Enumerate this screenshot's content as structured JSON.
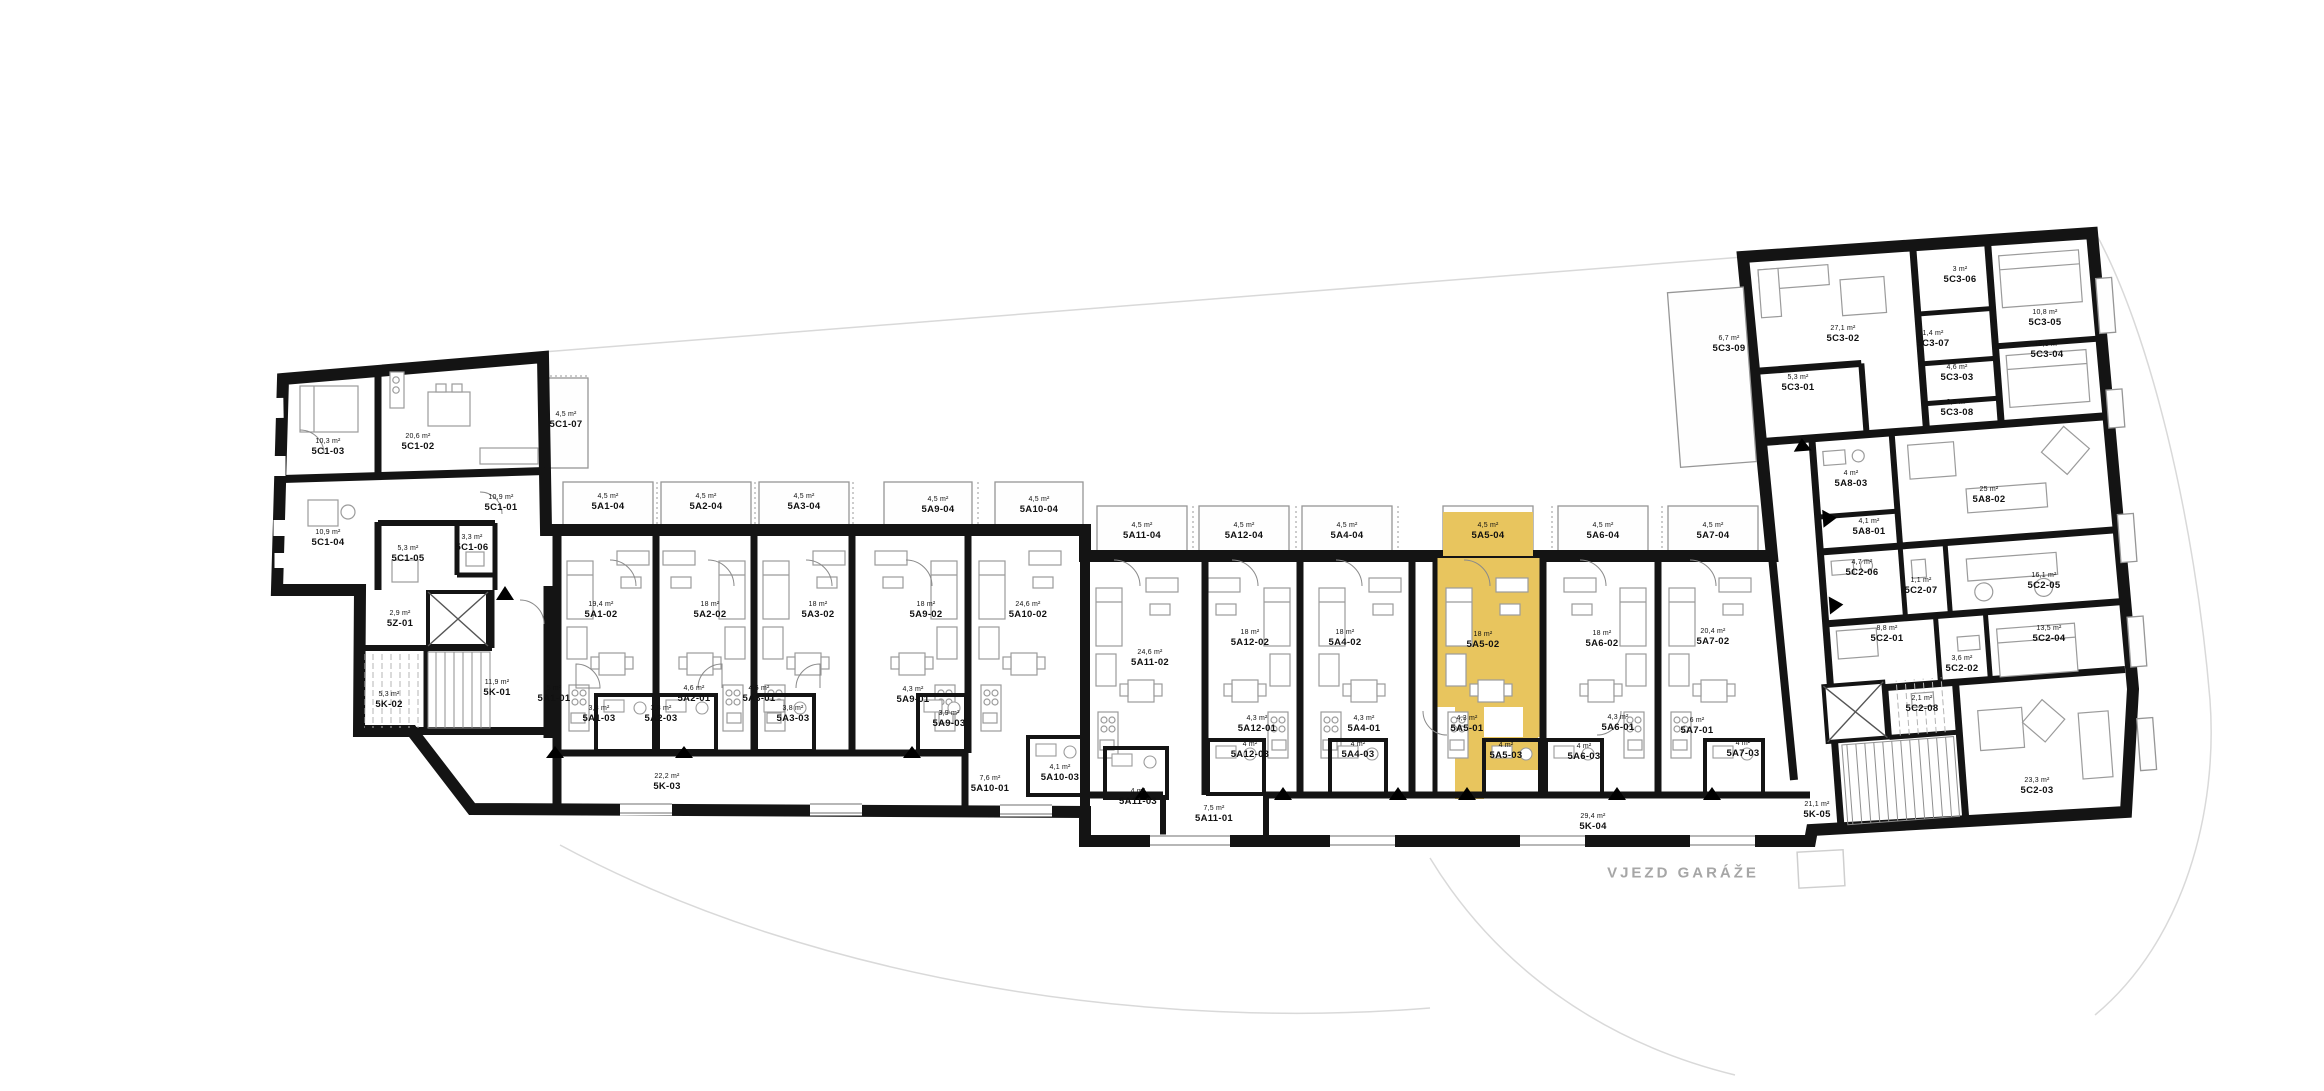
{
  "plan": {
    "highlight_color": "#E8C55E",
    "highlighted_unit": "5A5",
    "site_label": "VJEZD GARÁŽE",
    "site_label_pos": {
      "x": 1683,
      "y": 873
    },
    "labels": [
      {
        "code": "5C1-03",
        "area": "10,3 m²",
        "x": 328,
        "y": 450
      },
      {
        "code": "5C1-02",
        "area": "20,6 m²",
        "x": 418,
        "y": 445
      },
      {
        "code": "5C1-07",
        "area": "4,5 m²",
        "x": 566,
        "y": 423
      },
      {
        "code": "5C1-01",
        "area": "10,9 m²",
        "x": 501,
        "y": 506
      },
      {
        "code": "5C1-04",
        "area": "10,9 m²",
        "x": 328,
        "y": 541
      },
      {
        "code": "5C1-05",
        "area": "5,3 m²",
        "x": 408,
        "y": 557
      },
      {
        "code": "5C1-06",
        "area": "3,3 m²",
        "x": 472,
        "y": 546
      },
      {
        "code": "5Z-01",
        "area": "2,9 m²",
        "x": 400,
        "y": 622
      },
      {
        "code": "5K-02",
        "area": "5,3 m²",
        "x": 389,
        "y": 703
      },
      {
        "code": "5K-01",
        "area": "11,9 m²",
        "x": 497,
        "y": 691
      },
      {
        "code": "5A1-04",
        "area": "4,5 m²",
        "x": 608,
        "y": 505
      },
      {
        "code": "5A2-04",
        "area": "4,5 m²",
        "x": 706,
        "y": 505
      },
      {
        "code": "5A3-04",
        "area": "4,5 m²",
        "x": 804,
        "y": 505
      },
      {
        "code": "5A9-04",
        "area": "4,5 m²",
        "x": 938,
        "y": 508
      },
      {
        "code": "5A10-04",
        "area": "4,5 m²",
        "x": 1039,
        "y": 508
      },
      {
        "code": "5A11-04",
        "area": "4,5 m²",
        "x": 1142,
        "y": 534
      },
      {
        "code": "5A12-04",
        "area": "4,5 m²",
        "x": 1244,
        "y": 534
      },
      {
        "code": "5A4-04",
        "area": "4,5 m²",
        "x": 1347,
        "y": 534
      },
      {
        "code": "5A5-04",
        "area": "4,5 m²",
        "x": 1488,
        "y": 534,
        "hl": true
      },
      {
        "code": "5A6-04",
        "area": "4,5 m²",
        "x": 1603,
        "y": 534
      },
      {
        "code": "5A7-04",
        "area": "4,5 m²",
        "x": 1713,
        "y": 534
      },
      {
        "code": "5A1-02",
        "area": "19,4 m²",
        "x": 601,
        "y": 613
      },
      {
        "code": "5A2-02",
        "area": "18 m²",
        "x": 710,
        "y": 613
      },
      {
        "code": "5A3-02",
        "area": "18 m²",
        "x": 818,
        "y": 613
      },
      {
        "code": "5A9-02",
        "area": "18 m²",
        "x": 926,
        "y": 613
      },
      {
        "code": "5A10-02",
        "area": "24,6 m²",
        "x": 1028,
        "y": 613
      },
      {
        "code": "5A11-02",
        "area": "24,6 m²",
        "x": 1150,
        "y": 661
      },
      {
        "code": "5A12-02",
        "area": "18 m²",
        "x": 1250,
        "y": 641
      },
      {
        "code": "5A4-02",
        "area": "18 m²",
        "x": 1345,
        "y": 641
      },
      {
        "code": "5A5-02",
        "area": "18 m²",
        "x": 1483,
        "y": 643,
        "hl": true
      },
      {
        "code": "5A6-02",
        "area": "18 m²",
        "x": 1602,
        "y": 642
      },
      {
        "code": "5A7-02",
        "area": "20,4 m²",
        "x": 1713,
        "y": 640
      },
      {
        "code": "5A1-01",
        "area": "5 m²",
        "x": 554,
        "y": 697
      },
      {
        "code": "5A1-03",
        "area": "3,8 m²",
        "x": 599,
        "y": 717
      },
      {
        "code": "5A2-03",
        "area": "3,8 m²",
        "x": 661,
        "y": 717
      },
      {
        "code": "5A2-01",
        "area": "4,6 m²",
        "x": 694,
        "y": 697
      },
      {
        "code": "5A3-01",
        "area": "4,6 m²",
        "x": 759,
        "y": 697
      },
      {
        "code": "5A3-03",
        "area": "3,8 m²",
        "x": 793,
        "y": 717
      },
      {
        "code": "5A9-01",
        "area": "4,3 m²",
        "x": 913,
        "y": 698
      },
      {
        "code": "5A9-03",
        "area": "3,9 m²",
        "x": 949,
        "y": 722
      },
      {
        "code": "5A10-01",
        "area": "7,6 m²",
        "x": 990,
        "y": 787
      },
      {
        "code": "5A10-03",
        "area": "4,1 m²",
        "x": 1060,
        "y": 776
      },
      {
        "code": "5A11-03",
        "area": "4 m²",
        "x": 1138,
        "y": 800
      },
      {
        "code": "5A11-01",
        "area": "7,5 m²",
        "x": 1214,
        "y": 817
      },
      {
        "code": "5A12-01",
        "area": "4,3 m²",
        "x": 1257,
        "y": 727
      },
      {
        "code": "5A12-03",
        "area": "4 m²",
        "x": 1250,
        "y": 753
      },
      {
        "code": "5A4-01",
        "area": "4,3 m²",
        "x": 1364,
        "y": 727
      },
      {
        "code": "5A4-03",
        "area": "4 m²",
        "x": 1358,
        "y": 753
      },
      {
        "code": "5A5-01",
        "area": "4,3 m²",
        "x": 1467,
        "y": 727,
        "hl": true
      },
      {
        "code": "5A5-03",
        "area": "4 m²",
        "x": 1506,
        "y": 754,
        "hl": true
      },
      {
        "code": "5A6-01",
        "area": "4,3 m²",
        "x": 1618,
        "y": 726
      },
      {
        "code": "5A6-03",
        "area": "4 m²",
        "x": 1584,
        "y": 755
      },
      {
        "code": "5A7-01",
        "area": "6 m²",
        "x": 1697,
        "y": 729
      },
      {
        "code": "5A7-03",
        "area": "4 m²",
        "x": 1743,
        "y": 752
      },
      {
        "code": "5K-03",
        "area": "22,2 m²",
        "x": 667,
        "y": 785
      },
      {
        "code": "5K-04",
        "area": "29,4 m²",
        "x": 1593,
        "y": 825
      },
      {
        "code": "5C3-09",
        "area": "6,7 m²",
        "x": 1729,
        "y": 347
      },
      {
        "code": "5C3-02",
        "area": "27,1 m²",
        "x": 1843,
        "y": 337
      },
      {
        "code": "5C3-06",
        "area": "3 m²",
        "x": 1960,
        "y": 278
      },
      {
        "code": "5C3-05",
        "area": "10,8 m²",
        "x": 2045,
        "y": 321
      },
      {
        "code": "5C3-07",
        "area": "1,4 m²",
        "x": 1933,
        "y": 342
      },
      {
        "code": "5C3-04",
        "area": "10,8 m²",
        "x": 2047,
        "y": 353
      },
      {
        "code": "5C3-03",
        "area": "4,6 m²",
        "x": 1957,
        "y": 376
      },
      {
        "code": "5C3-01",
        "area": "5,3 m²",
        "x": 1798,
        "y": 386
      },
      {
        "code": "5C3-08",
        "area": "2,6 m²",
        "x": 1957,
        "y": 411
      },
      {
        "code": "5A8-03",
        "area": "4 m²",
        "x": 1851,
        "y": 482
      },
      {
        "code": "5A8-02",
        "area": "25 m²",
        "x": 1989,
        "y": 498
      },
      {
        "code": "5A8-01",
        "area": "4,1 m²",
        "x": 1869,
        "y": 530
      },
      {
        "code": "5C2-06",
        "area": "4,7 m²",
        "x": 1862,
        "y": 571
      },
      {
        "code": "5C2-07",
        "area": "1,1 m²",
        "x": 1921,
        "y": 589
      },
      {
        "code": "5C2-05",
        "area": "16,1 m²",
        "x": 2044,
        "y": 584
      },
      {
        "code": "5C2-01",
        "area": "8,8 m²",
        "x": 1887,
        "y": 637
      },
      {
        "code": "5C2-04",
        "area": "13,5 m²",
        "x": 2049,
        "y": 637
      },
      {
        "code": "5C2-02",
        "area": "3,6 m²",
        "x": 1962,
        "y": 667
      },
      {
        "code": "5C2-08",
        "area": "2,1 m²",
        "x": 1922,
        "y": 707
      },
      {
        "code": "5K-05",
        "area": "21,1 m²",
        "x": 1817,
        "y": 813
      },
      {
        "code": "5C2-03",
        "area": "23,3 m²",
        "x": 2037,
        "y": 789
      }
    ]
  }
}
